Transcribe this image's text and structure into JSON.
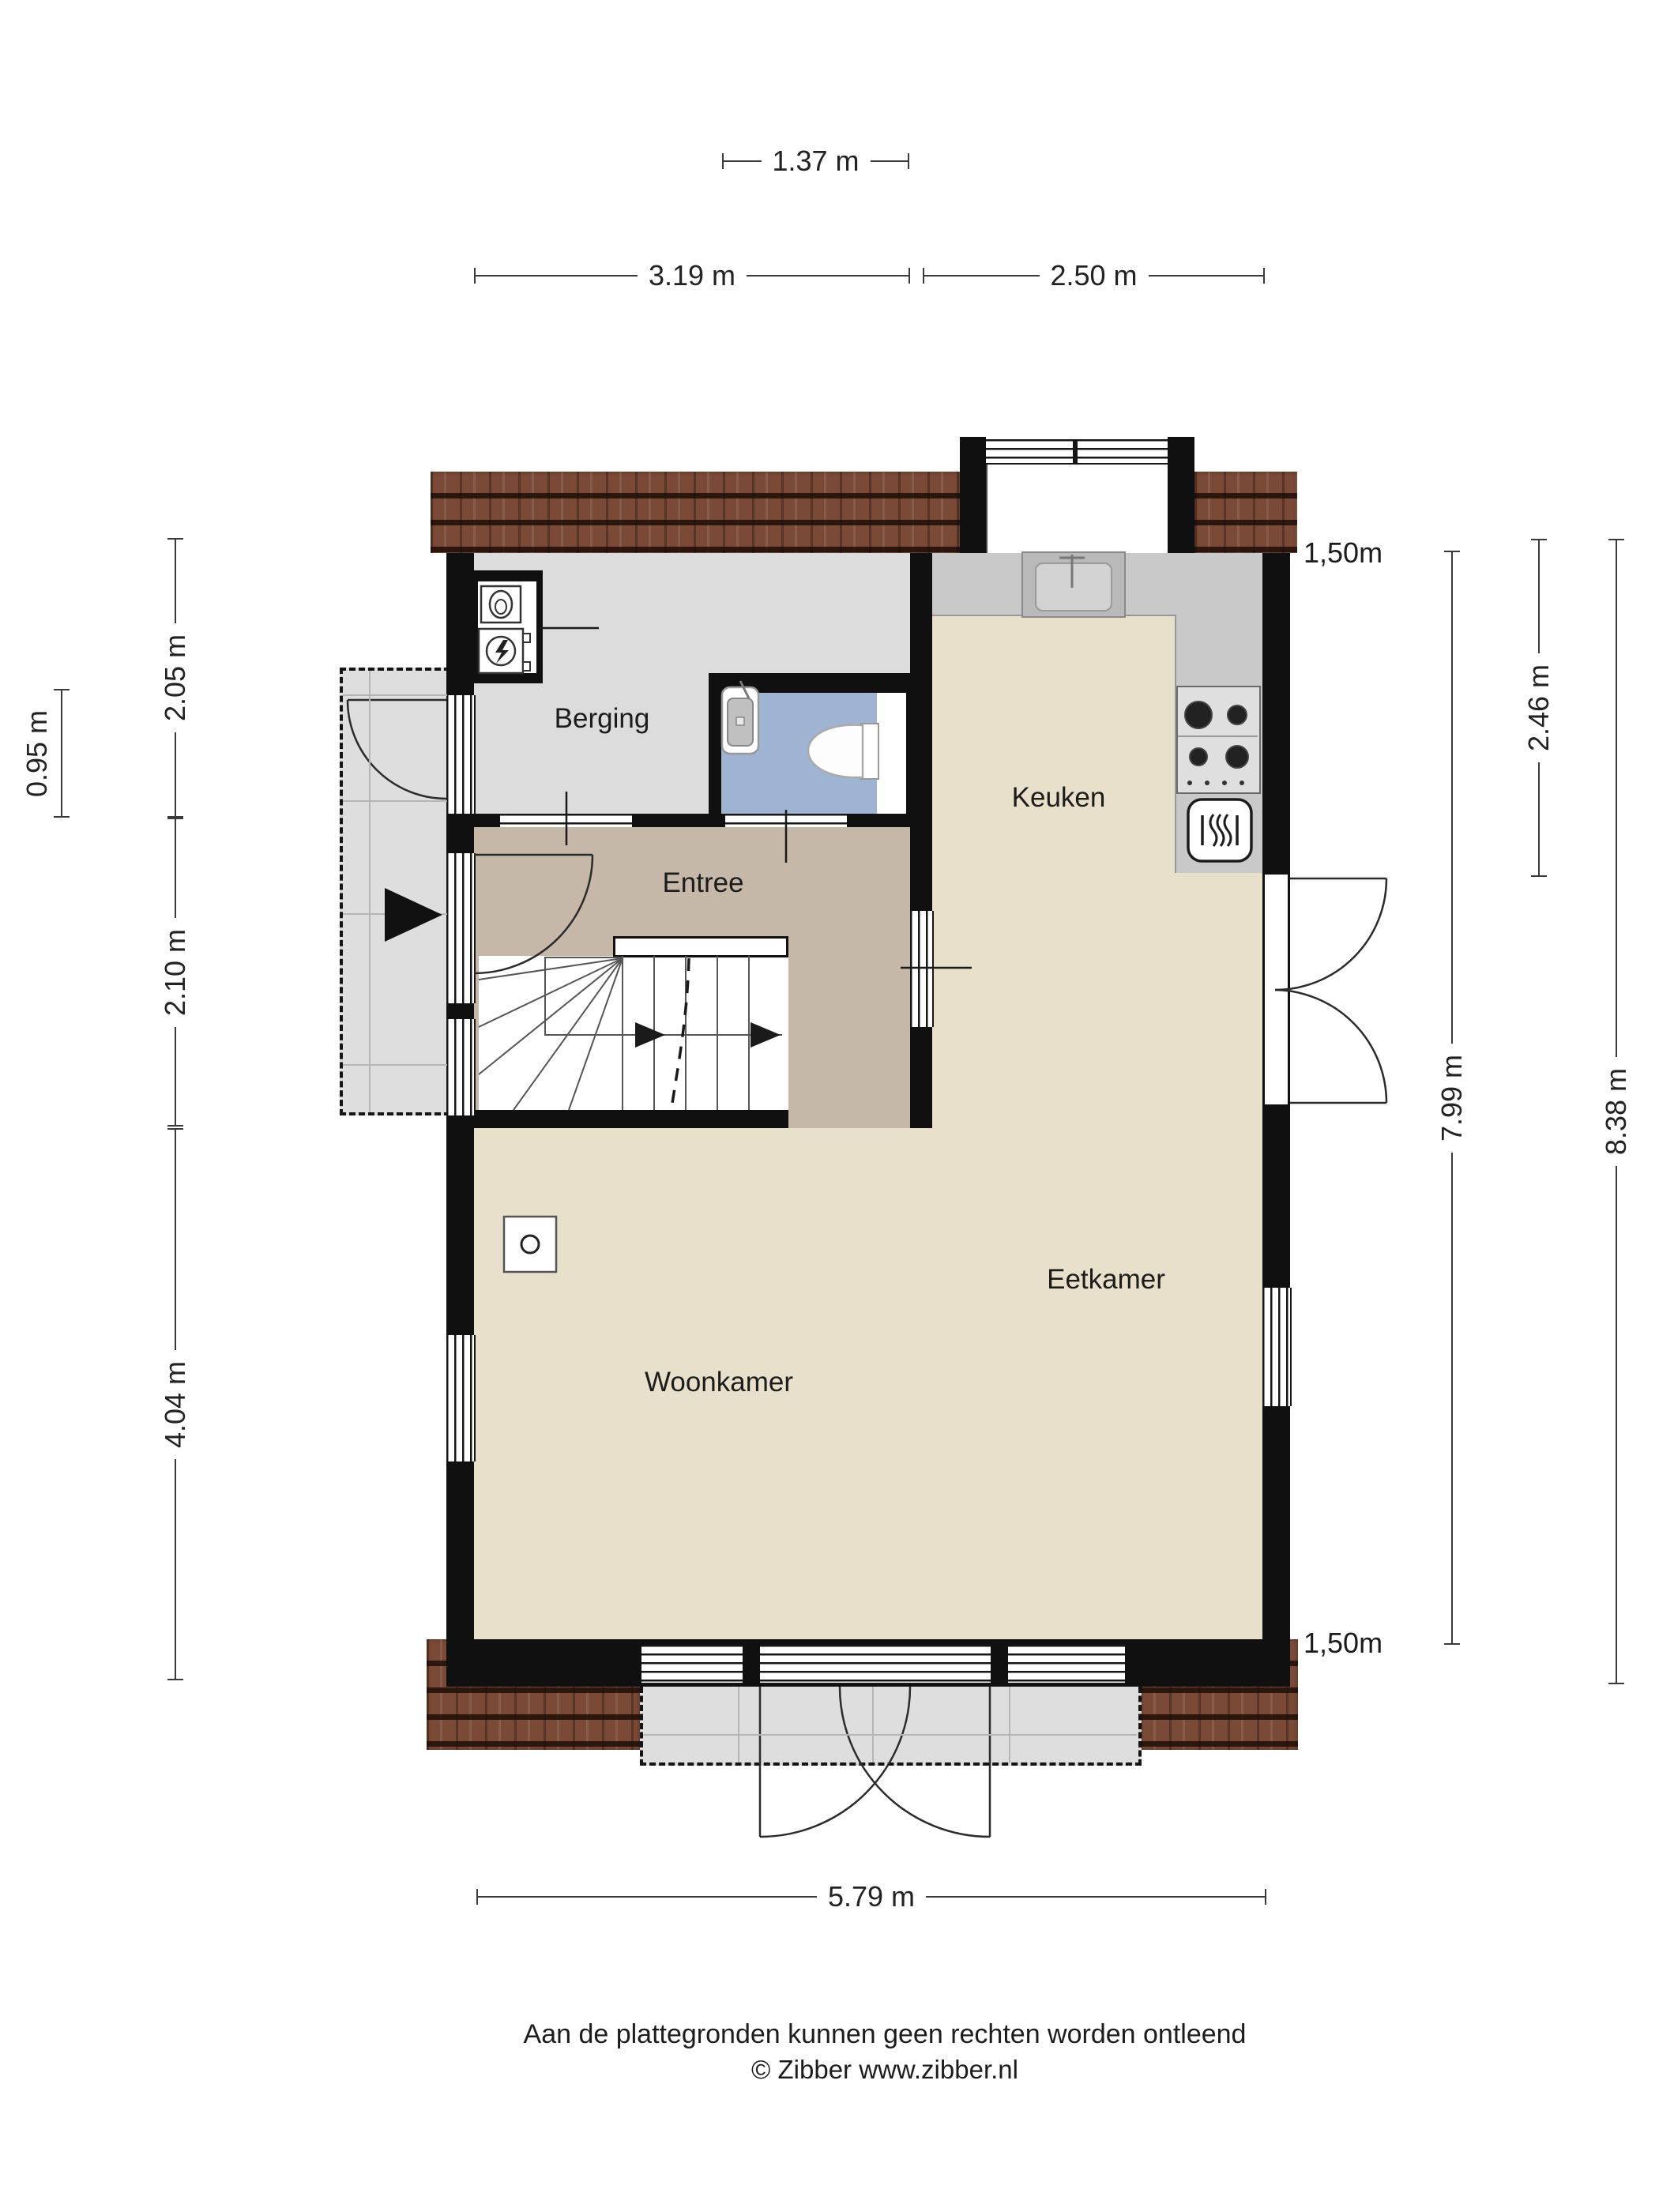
{
  "title": "Begane grond plattegrond",
  "rooms": {
    "berging": {
      "label": "Berging"
    },
    "entree": {
      "label": "Entree"
    },
    "keuken": {
      "label": "Keuken"
    },
    "eetkamer": {
      "label": "Eetkamer"
    },
    "woonkamer": {
      "label": "Woonkamer"
    }
  },
  "dims": {
    "d137": {
      "label": "1.37 m"
    },
    "d319": {
      "label": "3.19 m"
    },
    "d250": {
      "label": "2.50 m"
    },
    "d095": {
      "label": "0.95 m"
    },
    "d205": {
      "label": "2.05 m"
    },
    "d210": {
      "label": "2.10 m"
    },
    "d404": {
      "label": "4.04 m"
    },
    "d246": {
      "label": "2.46 m"
    },
    "d799": {
      "label": "7.99 m"
    },
    "d838": {
      "label": "8.38 m"
    },
    "d579": {
      "label": "5.79 m"
    },
    "eave_top": {
      "label": "1,50m"
    },
    "eave_bottom": {
      "label": "1,50m"
    }
  },
  "footer": {
    "line1": "Aan de plattegronden kunnen geen rechten worden ontleend",
    "line2": "© Zibber www.zibber.nl"
  },
  "colors": {
    "roof": "#7a4a36",
    "wall": "#101010",
    "floor_berging": "#dcdcdc",
    "floor_toilet": "#9fb3d2",
    "floor_entree": "#c6b8a8",
    "floor_living": "#e8e0ca",
    "counter": "#c9c9c9",
    "porch": "#dedede",
    "dim": "#3a3a3a"
  }
}
